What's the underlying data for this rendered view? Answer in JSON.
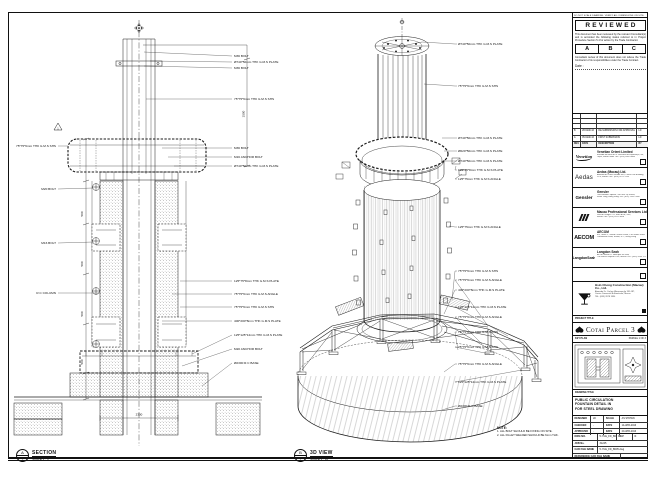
{
  "sheet": {
    "top_note": "DO NOT SCALE DRAWING. VERIFY ALL DIMENSIONS ON SITE."
  },
  "section": {
    "title": "SECTION",
    "scale": "SCALE 1 : 5",
    "marker": "A",
    "marker_sub": "-",
    "labels_right": [
      "M36 BOLT",
      "Ø740*50mm THK G.M.S PLATE",
      "M36 BOLT",
      "75*75*6mm THK G.M.S SHS",
      "M36 BOLT",
      "M16 ANCHOR BOLT",
      "Ø740*50mm THK G.M.S PLATE",
      "125*75*8mm THK G.M.S PLATE",
      "75*75*6mm THK G.M.S ANGLE",
      "75*75*6mm THK G.M.S SHS",
      "400*200*8mm THK G.M.S PLATE",
      "125*125*12mm THK G.M.S PLATE",
      "M20 ANCHOR BOLT",
      "Ø2300 R.C BASE"
    ],
    "labels_left": [
      "75*75*6mm THK G.M.S SHS",
      "M20 BOLT",
      "M16 BOLT",
      "R.C COLUMN"
    ],
    "dim_500": "500",
    "dim_1500": "1500",
    "dim_2300": "2300",
    "rev_marker": "1"
  },
  "iso": {
    "title": "3D VIEW",
    "scale": "SCALE 1 : 10",
    "marker": "B",
    "marker_sub": "-",
    "labels": [
      "Ø740*50mm THK G.M.S PLATE",
      "75*75*6mm THK G.M.S SHS",
      "Ø740*50mm THK G.M.S PLATE",
      "Ø620*50mm THK G.M.S PLATE",
      "Ø740*50mm THK G.M.S PLATE",
      "125*75*8mm THK G.M.S PLATE",
      "125*75mm THK G.M.S ANGLE",
      "125*75mm THK G.M.S ANGLE",
      "75*75*6mm THK G.M.S SHS",
      "75*75*6mm THK G.M.S ANGLE",
      "400*200*8mm THK G.M.S PLATE",
      "125*125*12mm THK G.M.S PLATE",
      "75*75*6mm THK G.M.S ANGLE",
      "75*75*6mm THK G.M.S SHS",
      "75*75*6mm THK G.M.S SHS",
      "75*75*6mm THK G.M.S ANGLE",
      "125*125*12mm THK G.M.S PLATE",
      "Ø2300 R.C BASE"
    ]
  },
  "notes": {
    "heading": "NOTE:",
    "items": [
      "1. ALL BOLT SHOULD BE FIXING ON SITE.",
      "2. ALL FILLET WELDED SHOULD BE 6mm THK."
    ]
  },
  "titleblock": {
    "reviewed": {
      "title": "REVIEWED",
      "p1": "This document has been reviewed by the relevant Consultant(s) and is accorded the following status referred to in Project Procedure Section 5.4 for action by the Trade Contractor.",
      "statuses": [
        "A",
        "B",
        "C"
      ],
      "p2": "Consultant review of this document does not relieve the Trade Contractor of its responsibilities under the Trade Contract.",
      "date_label": "Date :"
    },
    "revisions": {
      "headers": [
        "REV.",
        "DATE",
        "DESCRIPTION",
        "BY"
      ],
      "rows": [
        [
          "B",
          "28-MAR-16",
          "RE-SUBMISSION FOR APPROVAL",
          "LD"
        ],
        [
          "A",
          "05-MAR-16",
          "FIRST SUBMISSION",
          "LD"
        ]
      ]
    },
    "companies": [
      {
        "logo": "Venetian",
        "name": "Venetian Orient Limited",
        "sub1": "Estrada da Baía de N. Senhora da Esperança, s/n,",
        "sub2": "Taipa, Macau SAR   TEL: (853) 2882 8888"
      },
      {
        "logo": "Aedas",
        "name": "Aedas (Macau) Ltd.",
        "sub1": "Avenida da Praia Grande 409, China Law Building,",
        "sub2": "21/F, Macau   TEL: (853) 2871 5193"
      },
      {
        "logo": "Gensler",
        "name": "Gensler",
        "sub1": "Two Harbour Square, 180 Wai Yip Street,",
        "sub2": "Kwun Tong, Hong Kong   TEL: (852) 2598 7868"
      },
      {
        "logo": "///",
        "name": "Macau Professional Services Ltd.",
        "sub1": "Rua de Xangai 175, Edif. ACM, 14/F,",
        "sub2": "Macau   TEL: (853) 2875 3088"
      },
      {
        "logo": "AECOM",
        "name": "AECOM",
        "sub1": "8/F, Tower 2, Grand Central Plaza, 138 Shatin Rural",
        "sub2": "Committee Road, Shatin, N.T., Hong Kong"
      },
      {
        "logo": "LangdonSeah",
        "name": "Langdon Seah",
        "sub1": "Av. do Infante D. Henrique 43-53A,",
        "sub2": "The Macau Square 19/F, Macau   TEL: (853) 2833 1710"
      }
    ],
    "contractor": {
      "name": "Hsin Chong Construction (Macau) Co., Ltd.",
      "sub1": "Alameda Dr. Carlos d'Assumpção 181-187,",
      "sub2": "Centro Comercial Brilhantismo, Macau",
      "sub3": "TEL: (853) 2878 1830"
    },
    "project": {
      "label": "PROJECT TITLE",
      "name": "Cotai Parcel 3"
    },
    "keyplan": {
      "label": "KEY PLAN",
      "right_note": "PARCEL 1 OF 3"
    },
    "drawing": {
      "label": "DRAWING TITLE",
      "line1": "PUBLIC CIRCULATION",
      "line2": "FOUNTAIN DETAIL IN",
      "line3": "FOR STEEL DRAWING"
    },
    "fields": {
      "r1l": "DESIGNED",
      "r1v": "LD",
      "r1k": "SCALE",
      "r1x": "AS SHOWN",
      "r2l": "CHECKED",
      "r2v": "-",
      "r2k": "DATE",
      "r2x": "14-APR-2016",
      "r3l": "APPROVED",
      "r3v": "-",
      "r3k": "DATE",
      "r3x": "20-APR-2016",
      "dwg_label": "DWG NO.",
      "dwg_no": "5-YUE_FD_B005",
      "rev_label": "REV",
      "rev": "C",
      "job_label": "JOB No.",
      "job": "31245",
      "cad_label": "CAD FILE NAME",
      "cad": "5-YUE_FD_B005.dwg",
      "ref_label": "REFERENCE CAD FILE NAME",
      "ref": ""
    }
  }
}
